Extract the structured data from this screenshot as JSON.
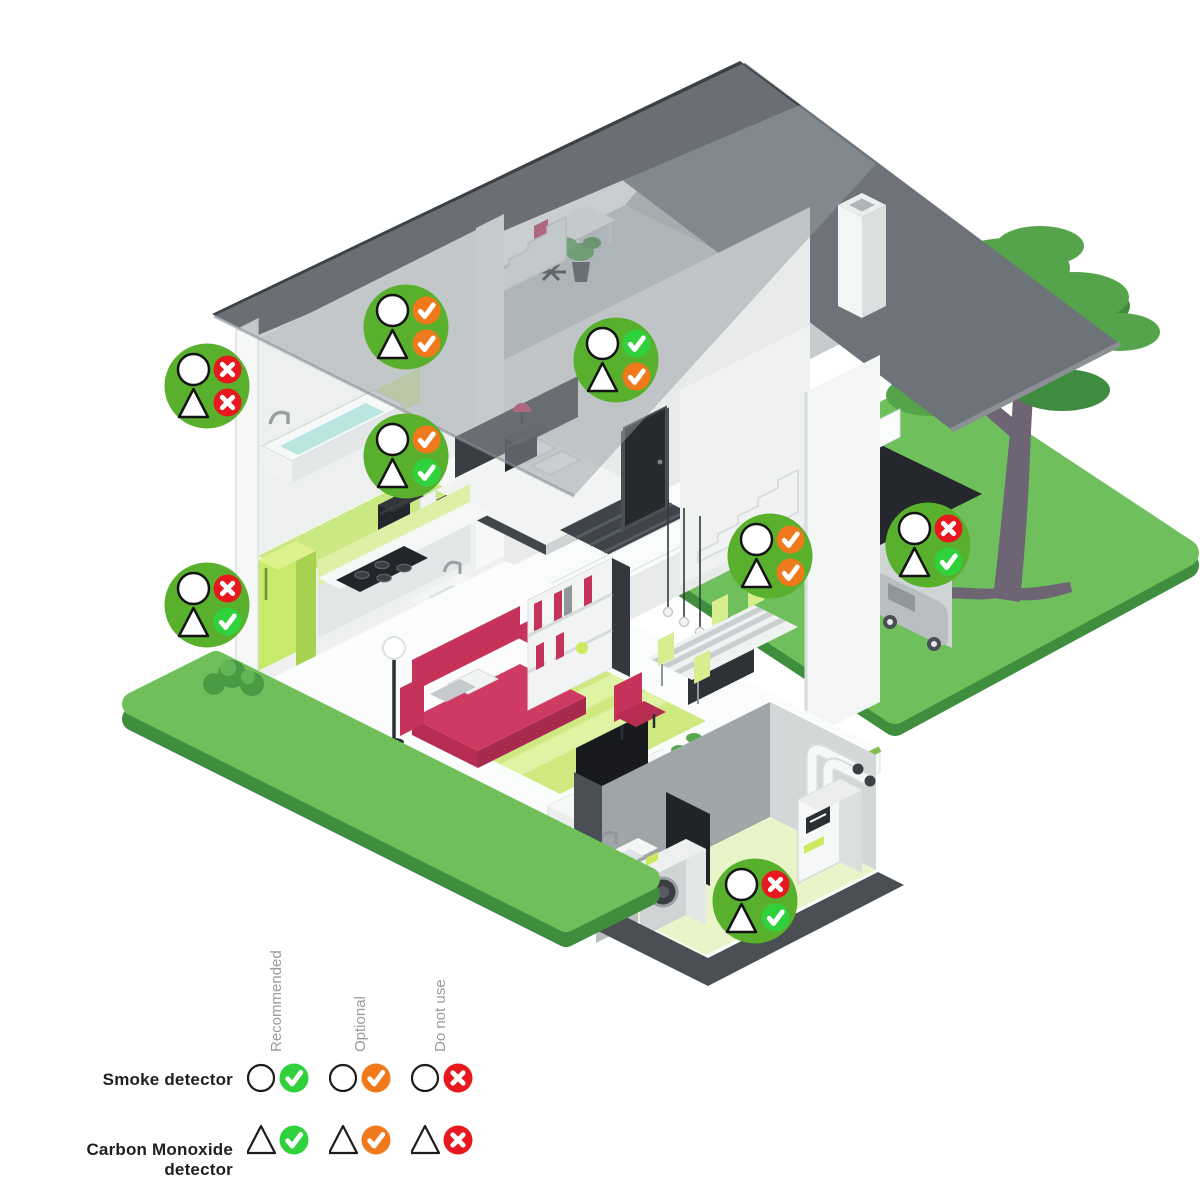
{
  "scene": {
    "description": "Isometric cutaway house infographic showing where to place smoke and carbon monoxide detectors",
    "background_color": "#ffffff"
  },
  "badge": {
    "bg_color": "#58b02c",
    "symbol_fill": "#ffffff",
    "symbol_stroke": "#141414"
  },
  "status_types": {
    "recommended": {
      "label": "Recommended",
      "color": "#2fd23c",
      "glyph": "check"
    },
    "optional": {
      "label": "Optional",
      "color": "#f0791c",
      "glyph": "check"
    },
    "do_not_use": {
      "label": "Do not use",
      "color": "#e7191f",
      "glyph": "cross"
    }
  },
  "legend": {
    "rows": [
      {
        "id": "smoke",
        "label": "Smoke detector",
        "symbol": "circle"
      },
      {
        "id": "co",
        "label": "Carbon Monoxide detector",
        "symbol": "triangle"
      }
    ],
    "columns": [
      {
        "id": "recommended",
        "label": "Recommended"
      },
      {
        "id": "optional",
        "label": "Optional"
      },
      {
        "id": "do_not_use",
        "label": "Do not use"
      }
    ]
  },
  "markers": [
    {
      "room": "bathroom",
      "x": 207,
      "y": 386,
      "smoke": "do_not_use",
      "co": "do_not_use"
    },
    {
      "room": "attic",
      "x": 406,
      "y": 327,
      "smoke": "optional",
      "co": "optional"
    },
    {
      "room": "upstairs-landing",
      "x": 616,
      "y": 360,
      "smoke": "recommended",
      "co": "optional"
    },
    {
      "room": "bedroom",
      "x": 406,
      "y": 456,
      "smoke": "optional",
      "co": "recommended"
    },
    {
      "room": "kitchen",
      "x": 207,
      "y": 605,
      "smoke": "do_not_use",
      "co": "recommended"
    },
    {
      "room": "hallway",
      "x": 770,
      "y": 556,
      "smoke": "optional",
      "co": "optional"
    },
    {
      "room": "garage",
      "x": 928,
      "y": 545,
      "smoke": "do_not_use",
      "co": "recommended"
    },
    {
      "room": "basement",
      "x": 755,
      "y": 901,
      "smoke": "do_not_use",
      "co": "recommended"
    }
  ]
}
